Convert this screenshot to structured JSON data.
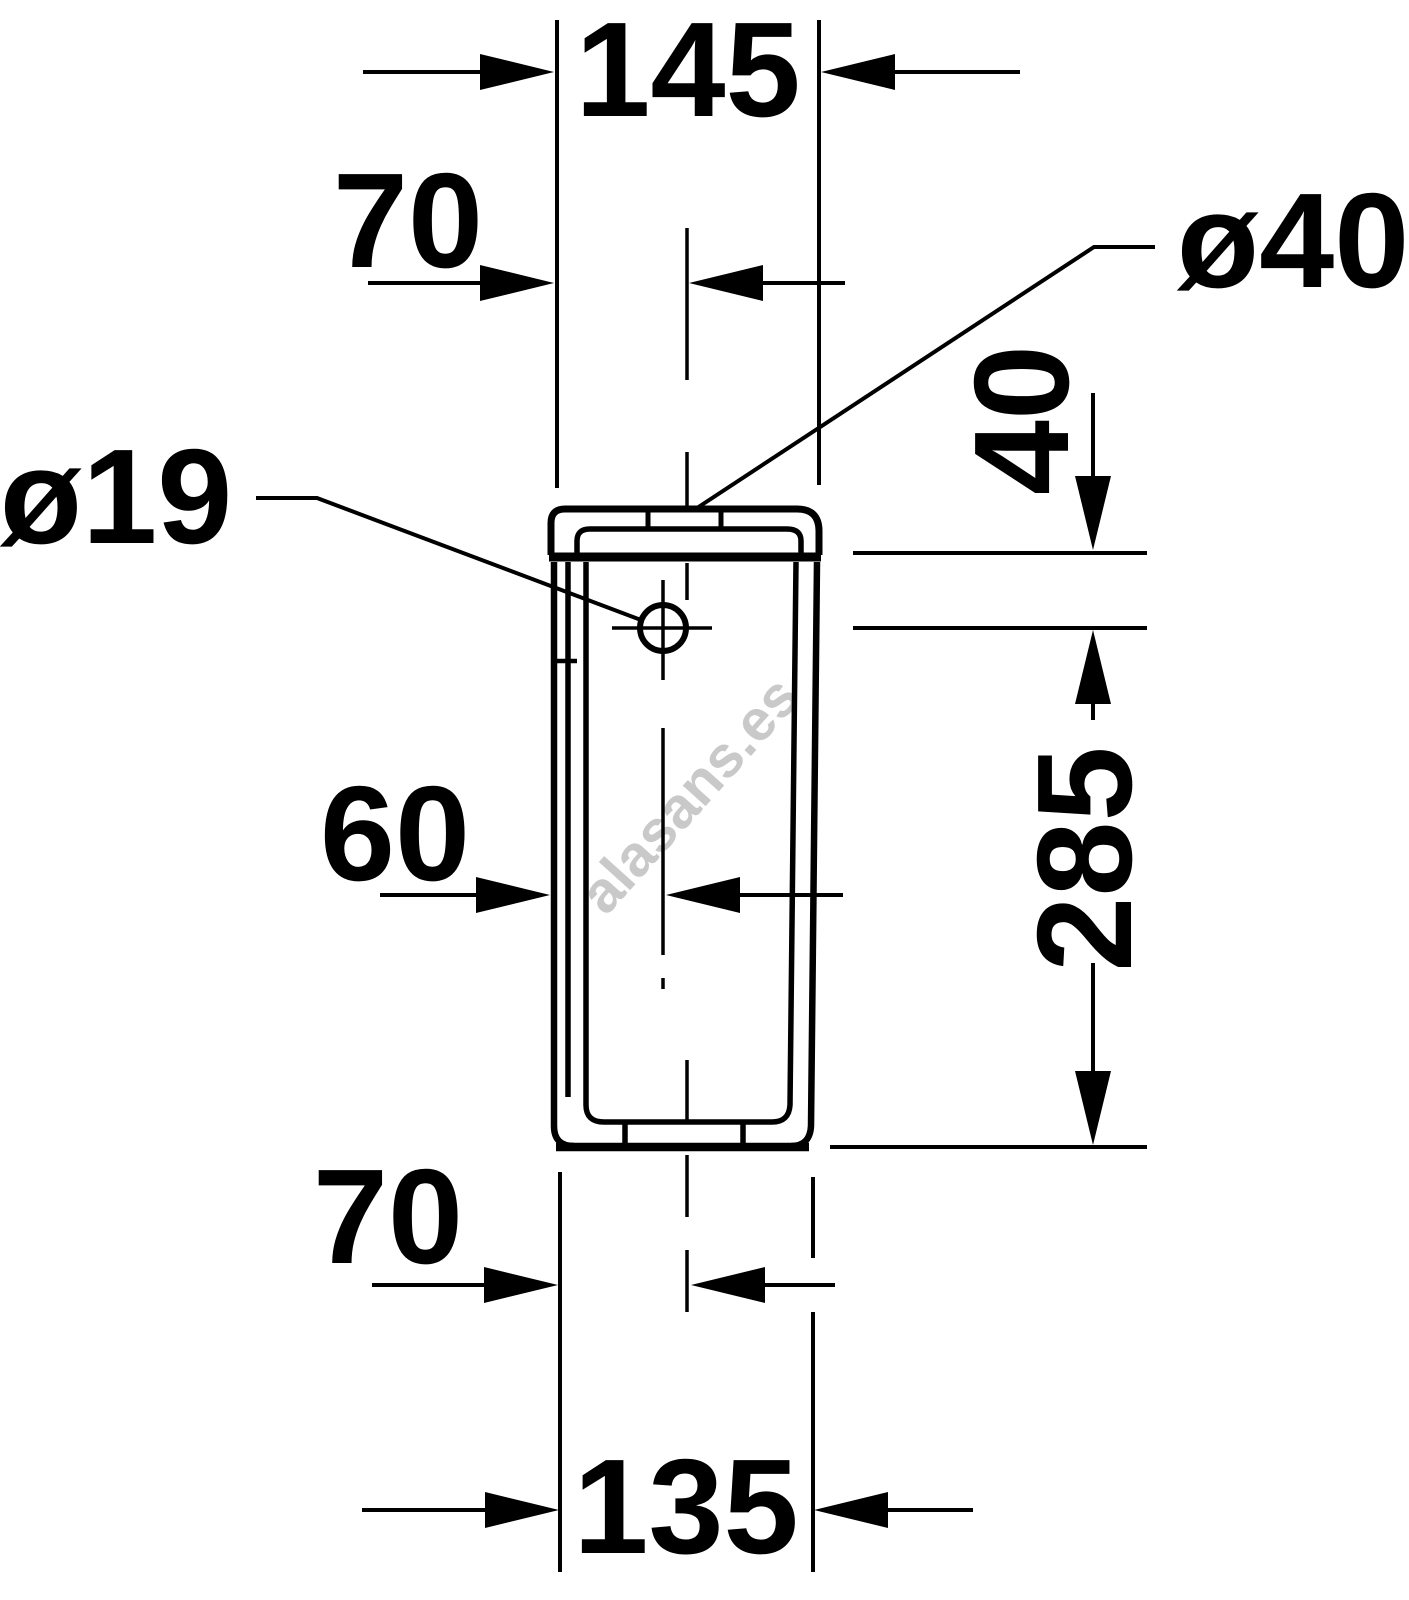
{
  "colors": {
    "ink": "#000000",
    "background": "#ffffff",
    "watermark": "#c9c9c9"
  },
  "watermark": {
    "text": "alasans.es"
  },
  "dims": {
    "lid_width": "145",
    "inlet_offset_top": "70",
    "lid_hole_diameter": "ø40",
    "side_hole_diameter": "ø19",
    "lid_to_side_hole": "40",
    "side_hole_to_base": "285",
    "side_hole_offset": "60",
    "inlet_offset_bottom": "70",
    "base_width": "135"
  }
}
